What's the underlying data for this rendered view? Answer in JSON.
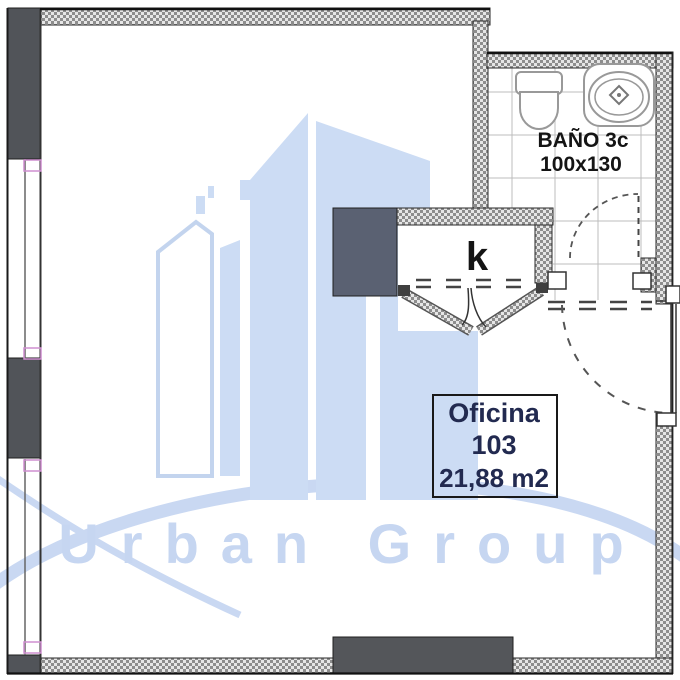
{
  "watermark": {
    "brand": "Urban Group",
    "accent_color": "#c6d6f1",
    "building_color": "#ccdcf4"
  },
  "labels": {
    "bathroom_name": "BAÑO 3c",
    "bathroom_dims": "100x130",
    "kitchen": "k",
    "office_title": "Oficina",
    "office_number": "103",
    "office_area": "21,88 m2"
  },
  "colors": {
    "wall_solid": "#515459",
    "wall_hatch_dot": "#8d8d8d",
    "window_accent": "#cf8fd0",
    "office_text": "#222a50",
    "line": "#1a1a1a"
  }
}
